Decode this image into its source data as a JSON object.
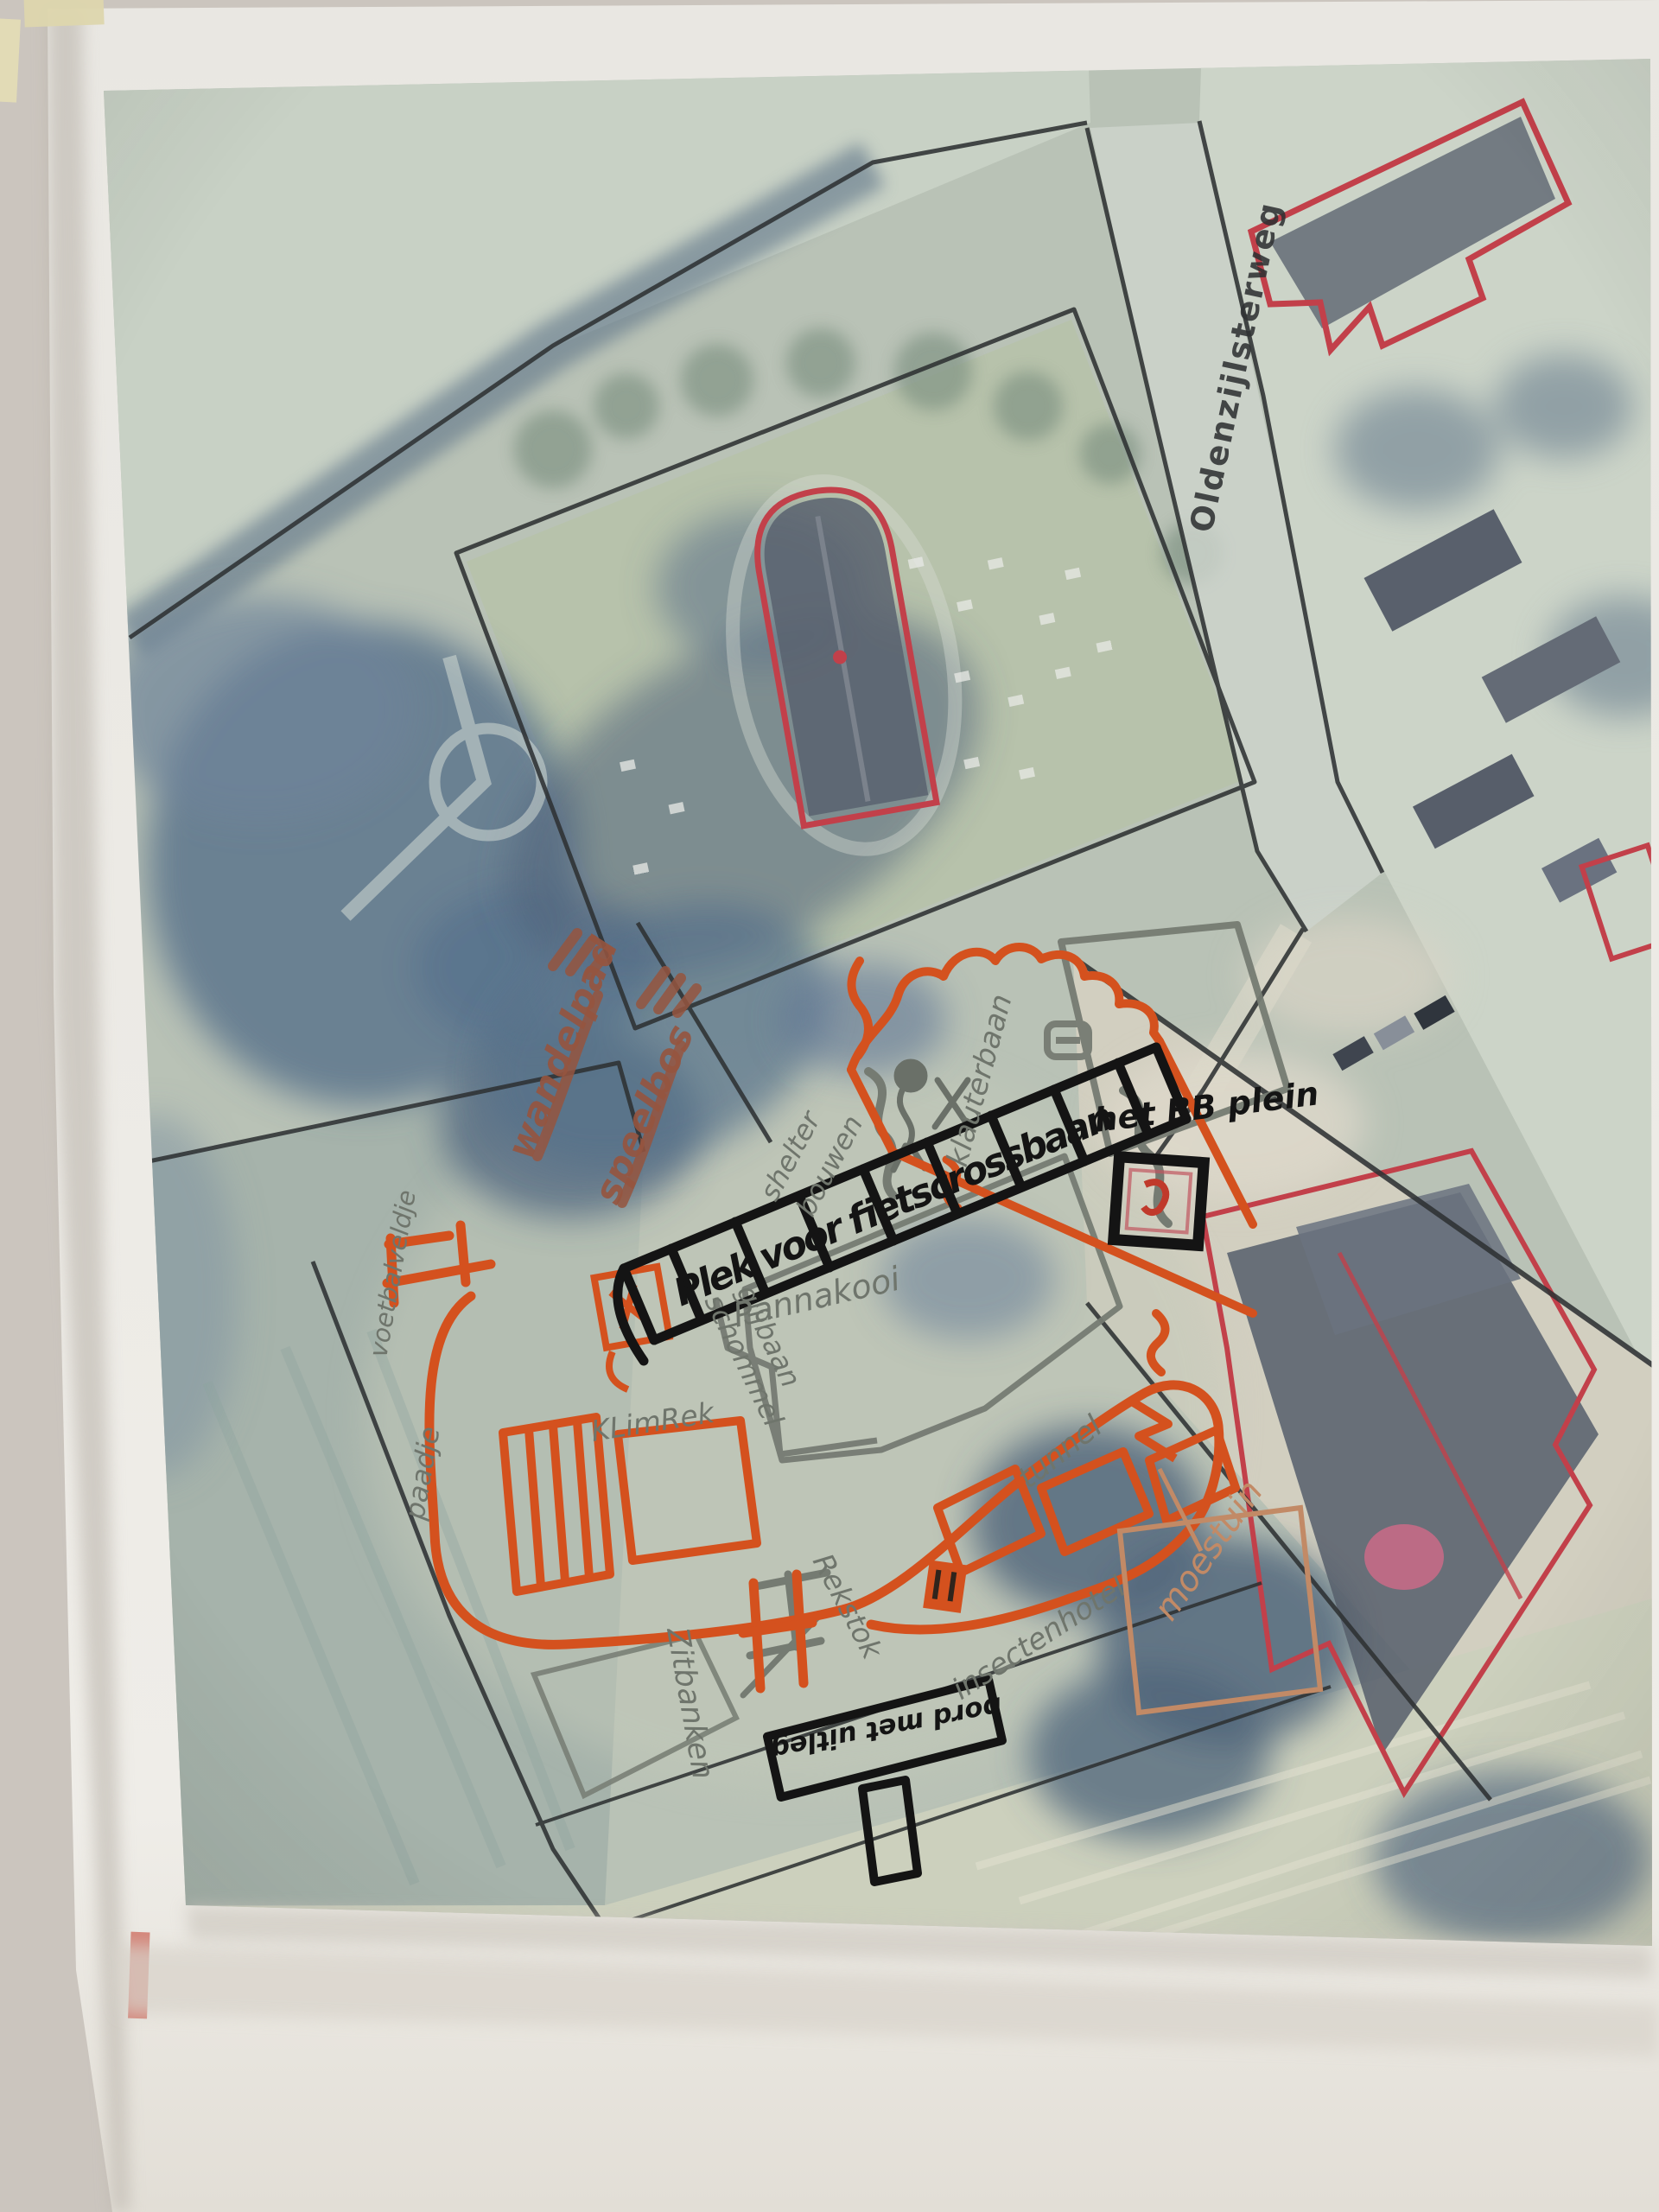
{
  "map": {
    "street_label": "Oldenzijlsterweg"
  },
  "annotations": {
    "black": {
      "hatch_label": "Plek voor fietscrossbaan",
      "bb_area": "het BB plein",
      "sign_board": "bord met uitleg"
    },
    "gray": {
      "pannakooi": "Pannakooi",
      "klimrek": "KLimRek",
      "rekstok": "Rekstok",
      "tunnel": "tunnel",
      "klauterbaan": "klauterbaan",
      "shelter_line1": "shelter",
      "shelter_line2": "bouwen",
      "schommel": "schommel",
      "glijbaan": "glijbaan",
      "zitbanken": "Zitbanken",
      "voetbalveldje": "voetbalveldje",
      "paadje": "paadje",
      "insectenhotel": "insectenhotel"
    },
    "brown": {
      "line1": "wandelpad",
      "line2": "speelbos"
    },
    "tan": {
      "moestuin": "moestuin"
    }
  },
  "colors": {
    "paper": "#edebe6",
    "map_base": "#b9c2b6",
    "tree_shadow": "#56708a",
    "print_line": "#2e3133",
    "print_red": "#c2404a",
    "marker_black": "#171717",
    "marker_orange": "#d4511e",
    "marker_gray": "#6f756c",
    "marker_brown": "#96553f",
    "marker_tan": "#c28a66",
    "tape": "#ddd6ad",
    "salmon_strip": "#d27b6f"
  }
}
